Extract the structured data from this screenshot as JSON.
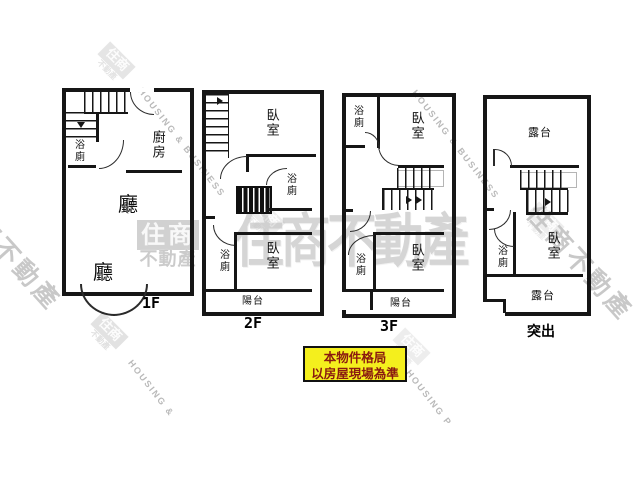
{
  "floors": {
    "f1": {
      "label": "1F",
      "bath": "浴廁",
      "kitchen": "廚房",
      "living_upper": "廳",
      "living_lower": "廳"
    },
    "f2": {
      "label": "2F",
      "bedroom_top": "臥室",
      "bath_top": "浴廁",
      "bath_bottom": "浴廁",
      "bedroom_bottom": "臥室",
      "balcony": "陽台"
    },
    "f3": {
      "label": "3F",
      "bath_top": "浴廁",
      "bedroom_top": "臥室",
      "bath_bottom": "浴廁",
      "bedroom_bottom": "臥室",
      "balcony": "陽台"
    },
    "f4": {
      "label": "突出",
      "terrace_top": "露台",
      "bath": "浴廁",
      "bedroom": "臥室",
      "terrace_bottom": "露台"
    }
  },
  "notice": {
    "line1": "本物件格局",
    "line2": "以房屋現場為準"
  },
  "watermarks": {
    "brand_name": "住商不動產",
    "logo_top": "住商",
    "logo_bottom": "不動產",
    "housing_business": "HOUSING & BUSINESS",
    "housing_amp": "HOUSING &",
    "housing_p": "HOUSING P",
    "stray_char": "產"
  },
  "colors": {
    "wall": "#161616",
    "watermark_gray": "#c6c6c6",
    "notice_bg": "#f4ef1d",
    "notice_text": "#8a1a10"
  }
}
